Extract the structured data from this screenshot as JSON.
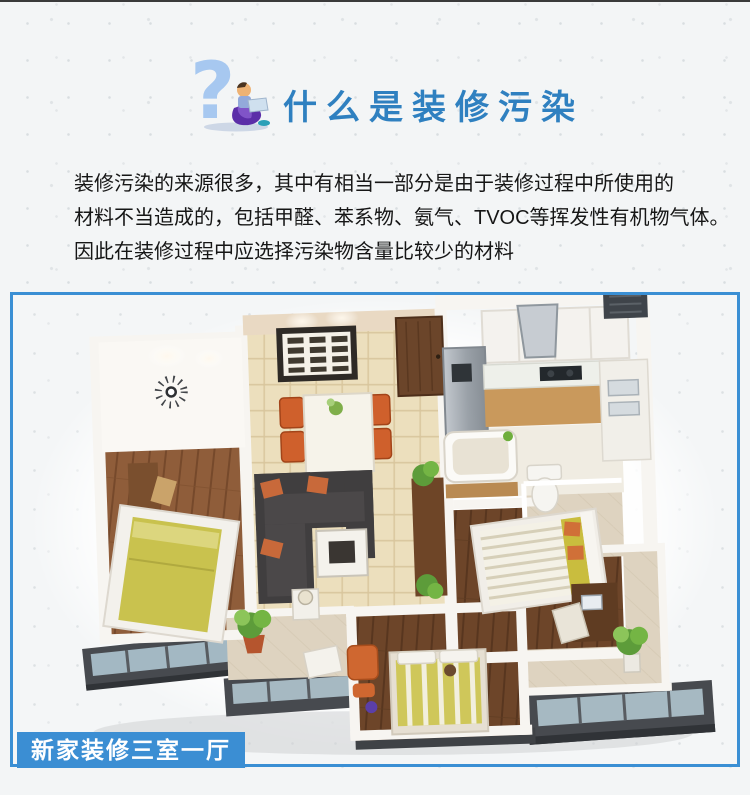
{
  "page": {
    "top_strip_color": "#3a3a3a",
    "background_color": "#f3f5f6"
  },
  "header": {
    "icon": "question-mark-reader-icon",
    "title": "什么是装修污染",
    "title_color": "#2f80c0"
  },
  "intro": {
    "lines": [
      "装修污染的来源很多，其中有相当一部分是由于装修过程中所使用的",
      "材料不当造成的，包括甲醛、苯系物、氨气、TVOC等挥发性有机物气体。",
      "因此在装修过程中应选择污染物含量比较少的材料"
    ]
  },
  "figure": {
    "illustration": "isometric-3d-floorplan",
    "border_color": "#3a8fd4",
    "badge": {
      "label": "新家装修三室一厅",
      "background_color": "#3b8ed3",
      "text_color": "#ffffff"
    }
  }
}
